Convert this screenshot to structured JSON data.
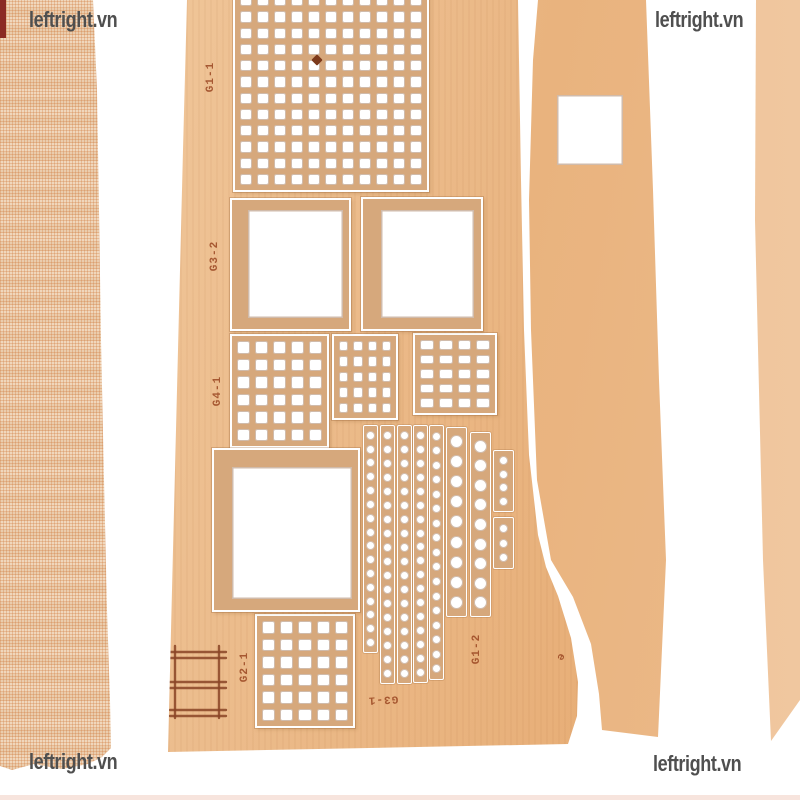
{
  "watermark": {
    "text": "leftright.vn",
    "color": "#4f4f4f"
  },
  "colors": {
    "background": "#ffffff",
    "fabric": "#eed3b5",
    "sheet_light": "#f2cba0",
    "sheet_mid": "#ecbc8c",
    "sheet_deep": "#e7ae77",
    "plank": "#e9b37e",
    "farstrip": "#f0c79f",
    "grating_bar": "#d6a87c",
    "engraving": "#9d4a25",
    "hole_rim": "rgba(138,84,44,0.4)",
    "red_tab": "#8b2a24",
    "bottom_strip": "#f7e4dd",
    "ladder": "#8a4526"
  },
  "parts": {
    "gratings": [
      {
        "name": "grating-g1-1",
        "x": 233,
        "y": -12,
        "w": 196,
        "h": 204,
        "cols": 11,
        "rows": 12
      },
      {
        "name": "grating-g4-1-a",
        "x": 230,
        "y": 334,
        "w": 99,
        "h": 114,
        "cols": 5,
        "rows": 6
      },
      {
        "name": "grating-g4-1-b",
        "x": 332,
        "y": 334,
        "w": 66,
        "h": 86,
        "cols": 4,
        "rows": 5
      },
      {
        "name": "grating-g4-1-c",
        "x": 413,
        "y": 333,
        "w": 84,
        "h": 82,
        "cols": 4,
        "rows": 5
      },
      {
        "name": "grating-g2-1",
        "x": 255,
        "y": 614,
        "w": 100,
        "h": 114,
        "cols": 5,
        "rows": 6
      }
    ],
    "frames": [
      {
        "name": "frame-g3-2-left",
        "x": 230,
        "y": 198,
        "w": 121,
        "h": 133,
        "hx": 16,
        "hy": 10,
        "hw": 95,
        "hh": 108
      },
      {
        "name": "frame-g3-2-right",
        "x": 361,
        "y": 197,
        "w": 122,
        "h": 134,
        "hx": 18,
        "hy": 11,
        "hw": 93,
        "hh": 108
      },
      {
        "name": "frame-large",
        "x": 212,
        "y": 448,
        "w": 148,
        "h": 164,
        "hx": 18,
        "hy": 17,
        "hw": 120,
        "hh": 132
      }
    ],
    "hole_strips": [
      {
        "name": "hole-strip-1",
        "x": 363,
        "y": 425,
        "w": 15,
        "h": 228,
        "d": 9,
        "n": 16
      },
      {
        "name": "hole-strip-2",
        "x": 380,
        "y": 425,
        "w": 15,
        "h": 259,
        "d": 9,
        "n": 18
      },
      {
        "name": "hole-strip-3",
        "x": 397,
        "y": 425,
        "w": 15,
        "h": 259,
        "d": 9,
        "n": 18
      },
      {
        "name": "hole-strip-4",
        "x": 413,
        "y": 425,
        "w": 15,
        "h": 258,
        "d": 9,
        "n": 18
      },
      {
        "name": "hole-strip-5",
        "x": 429,
        "y": 425,
        "w": 15,
        "h": 255,
        "d": 9,
        "n": 17
      },
      {
        "name": "hole-strip-6",
        "x": 446,
        "y": 427,
        "w": 21,
        "h": 190,
        "d": 13,
        "n": 9
      },
      {
        "name": "hole-strip-7",
        "x": 470,
        "y": 432,
        "w": 21,
        "h": 185,
        "d": 13,
        "n": 9
      },
      {
        "name": "hole-strip-8",
        "x": 493,
        "y": 450,
        "w": 21,
        "h": 62,
        "d": 9,
        "n": 4
      },
      {
        "name": "hole-strip-9",
        "x": 493,
        "y": 517,
        "w": 21,
        "h": 52,
        "d": 9,
        "n": 3
      }
    ],
    "labels": [
      {
        "text": "G1-1",
        "x": 211,
        "y": 77,
        "rot": -90
      },
      {
        "text": "G3-2",
        "x": 215,
        "y": 256,
        "rot": -90
      },
      {
        "text": "G4-1",
        "x": 218,
        "y": 391,
        "rot": -90
      },
      {
        "text": "G2-1",
        "x": 245,
        "y": 667,
        "rot": -90
      },
      {
        "text": "G3-1",
        "x": 383,
        "y": 699,
        "rot": 177
      },
      {
        "text": "G1-2",
        "x": 477,
        "y": 649,
        "rot": -90
      },
      {
        "text": "e",
        "x": 560,
        "y": 657,
        "rot": 115
      }
    ],
    "ladder": {
      "x": 170,
      "y": 644,
      "w": 58,
      "h": 76,
      "rails": [
        5,
        49
      ],
      "rungs": [
        8,
        14,
        38,
        44,
        66,
        72
      ]
    },
    "knot": {
      "x": 313,
      "y": 56,
      "size": 8
    },
    "plank_square_hole": {
      "x": 557,
      "y": 95,
      "w": 66,
      "h": 70
    }
  }
}
